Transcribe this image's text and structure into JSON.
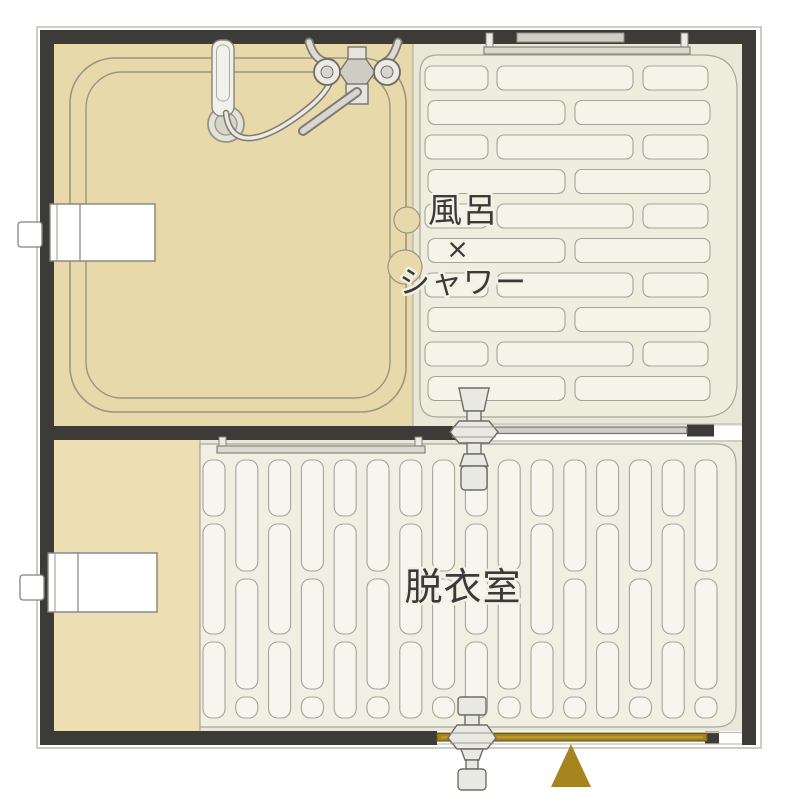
{
  "plan": {
    "type": "bathroom-floor-plan",
    "rooms": {
      "bath": {
        "label_line1": "風呂",
        "label_line2": "×",
        "label_line3": "シャワー"
      },
      "dressing": {
        "label": "脱衣室"
      }
    },
    "markers": {
      "entrance": {
        "shape": "triangle",
        "color_name": "gold"
      }
    }
  },
  "colors": {
    "wall": "#3c3b37",
    "bath_floor": "#e8d9aa",
    "dressing_floor": "#ecdfb4",
    "tile_area_bg": "#e9e7d7",
    "tile_panel": "#efeddd",
    "tile_brick": "#f6f4e8",
    "duckboard_bg": "#e9e7d8",
    "duckboard_panel": "#f1efe1",
    "slat": "#f7f6ee",
    "outline_gray": "#a6a498",
    "fixture_gray": "#e9e9e3",
    "gold": "#a5851f",
    "gold_dark": "#6e5a12",
    "gold_light": "#c2a436",
    "text": "#3a3a3a"
  }
}
